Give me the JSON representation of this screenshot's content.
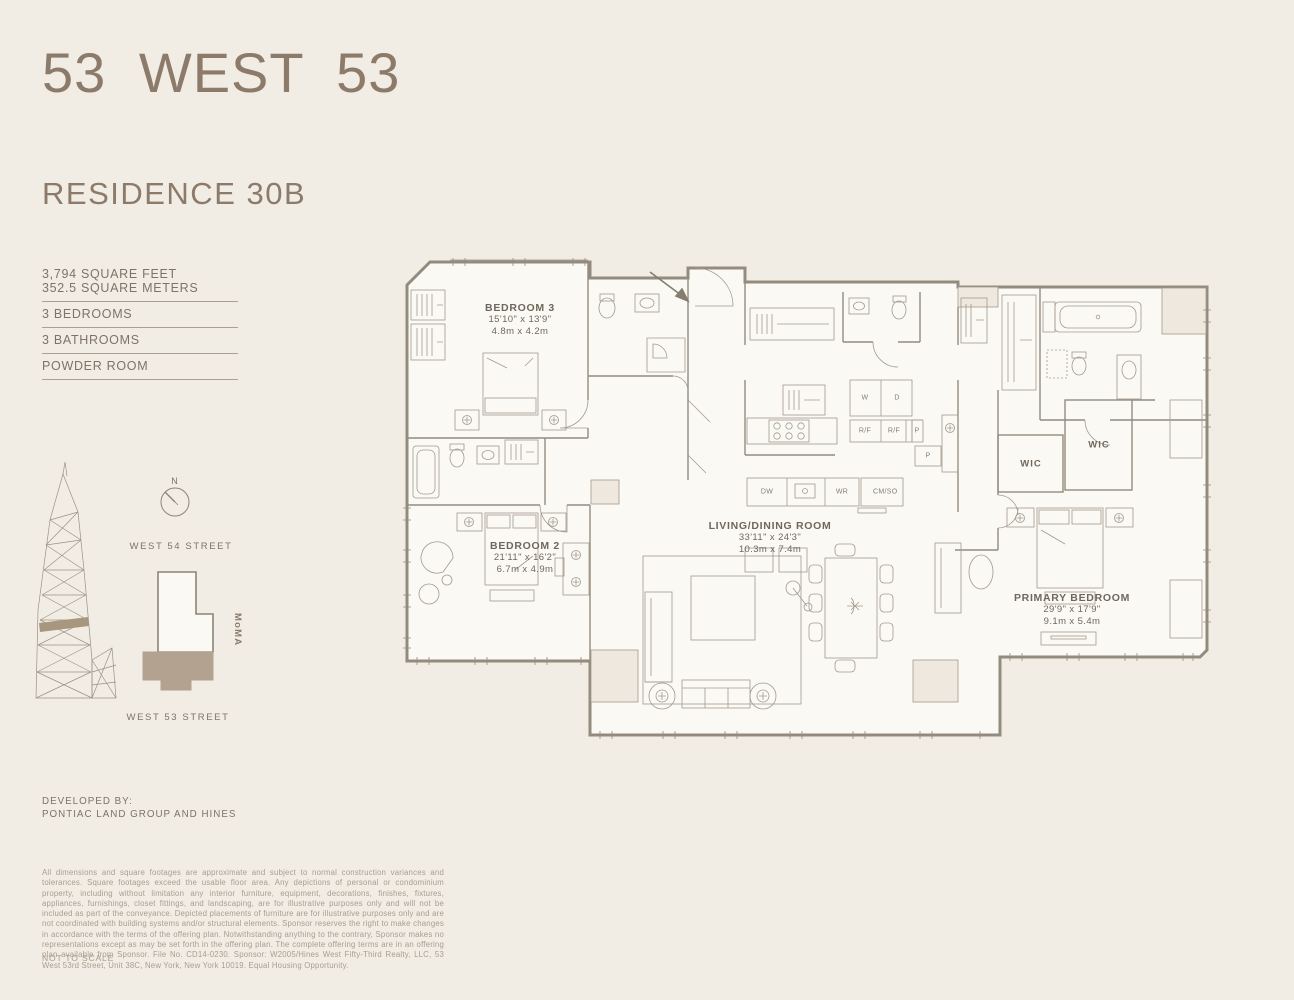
{
  "colors": {
    "background": "#f2ede4",
    "brand": "#8c7b6b",
    "body_text": "#7d7367",
    "plan_line": "#938b7e",
    "podium_fill": "#b3a290",
    "disclaimer_text": "#a89d8f"
  },
  "header": {
    "title": "53 WEST 53",
    "residence": "RESIDENCE 30B"
  },
  "stats": {
    "area_ft": "3,794 SQUARE FEET",
    "area_m": "352.5 SQUARE METERS",
    "bedrooms": "3 BEDROOMS",
    "bathrooms": "3 BATHROOMS",
    "powder": "POWDER ROOM"
  },
  "locator": {
    "compass": "N",
    "street_north": "WEST 54 STREET",
    "street_south": "WEST 53 STREET",
    "landmark": "MoMA"
  },
  "rooms": {
    "bedroom3": {
      "name": "BEDROOM 3",
      "imperial": "15'10\" x 13'9\"",
      "metric": "4.8m x 4.2m"
    },
    "bedroom2": {
      "name": "BEDROOM 2",
      "imperial": "21'11\" x 16'2\"",
      "metric": "6.7m x 4.9m"
    },
    "living": {
      "name": "LIVING/DINING ROOM",
      "imperial": "33'11\" x 24'3\"",
      "metric": "10.3m x 7.4m"
    },
    "primary": {
      "name": "PRIMARY BEDROOM",
      "imperial": "29'9\" x 17'9\"",
      "metric": "9.1m x 5.4m"
    }
  },
  "plan_labels": {
    "wic1": "WIC",
    "wic2": "WIC",
    "washer": "W",
    "dryer": "D",
    "rf1": "R/F",
    "rf2": "R/F",
    "p1": "P",
    "p2": "P",
    "dishwasher": "DW",
    "wine": "WR",
    "coffee": "CM/SO"
  },
  "footer": {
    "developed_by": "DEVELOPED BY:",
    "developer": "PONTIAC LAND GROUP AND HINES",
    "disclaimer": "All dimensions and square footages are approximate and subject to normal construction variances and tolerances. Square footages exceed the usable floor area. Any depictions of personal or condominium property, including without limitation any interior furniture, equipment, decorations, finishes, fixtures, appliances, furnishings, closet fittings, and landscaping, are for illustrative purposes only and will not be included as part of the conveyance. Depicted placements of furniture are for illustrative purposes only and are not coordinated with building systems and/or structural elements. Sponsor reserves the right to make changes in accordance with the terms of the offering plan. Notwithstanding anything to the contrary, Sponsor makes no representations except as may be set forth in the offering plan. The complete offering terms are in an offering plan available from Sponsor. File No. CD14-0230. Sponsor: W2005/Hines West Fifty-Third Realty, LLC, 53 West 53rd Street, Unit 38C, New York, New York 10019. Equal Housing Opportunity.",
    "scale_note": "NOT TO SCALE"
  }
}
